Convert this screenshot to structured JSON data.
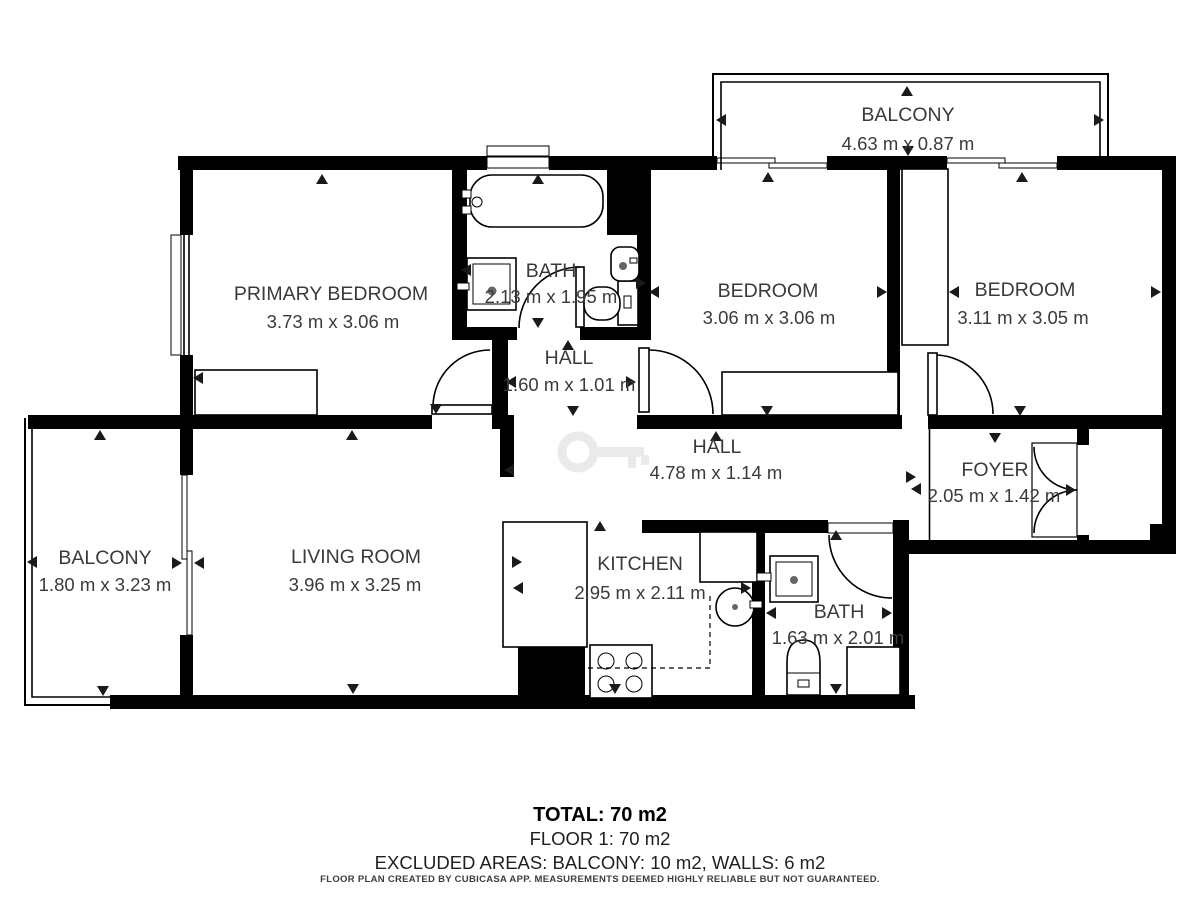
{
  "plan": {
    "rooms": {
      "balcony_top": {
        "name": "BALCONY",
        "dims": "4.63 m x 0.87 m"
      },
      "primary_bedroom": {
        "name": "PRIMARY BEDROOM",
        "dims": "3.73 m x 3.06 m"
      },
      "bath_upper": {
        "name": "BATH",
        "dims": "2.13 m x 1.95 m"
      },
      "hall_small": {
        "name": "HALL",
        "dims": "1.60 m x 1.01 m"
      },
      "bedroom_middle": {
        "name": "BEDROOM",
        "dims": "3.06 m x 3.06 m"
      },
      "bedroom_right": {
        "name": "BEDROOM",
        "dims": "3.11 m x 3.05 m"
      },
      "hall_main": {
        "name": "HALL",
        "dims": "4.78 m x 1.14 m"
      },
      "foyer": {
        "name": "FOYER",
        "dims": "2.05 m x 1.42 m"
      },
      "balcony_left": {
        "name": "BALCONY",
        "dims": "1.80 m x 3.23 m"
      },
      "living_room": {
        "name": "LIVING ROOM",
        "dims": "3.96 m x 3.25 m"
      },
      "kitchen": {
        "name": "KITCHEN",
        "dims": "2.95 m x 2.11 m"
      },
      "bath_lower": {
        "name": "BATH",
        "dims": "1.63 m x 2.01 m"
      }
    },
    "summary": {
      "total": "TOTAL: 70 m2",
      "floor": "FLOOR 1: 70 m2",
      "excluded": "EXCLUDED AREAS: BALCONY: 10 m2, WALLS: 6 m2",
      "disclaimer": "FLOOR PLAN CREATED BY CUBICASA APP. MEASUREMENTS DEEMED HIGHLY RELIABLE BUT NOT GUARANTEED."
    },
    "colors": {
      "wall": "#000000",
      "text": "#3a3a3a",
      "background": "#ffffff",
      "watermark": "#d9d9d9"
    }
  }
}
